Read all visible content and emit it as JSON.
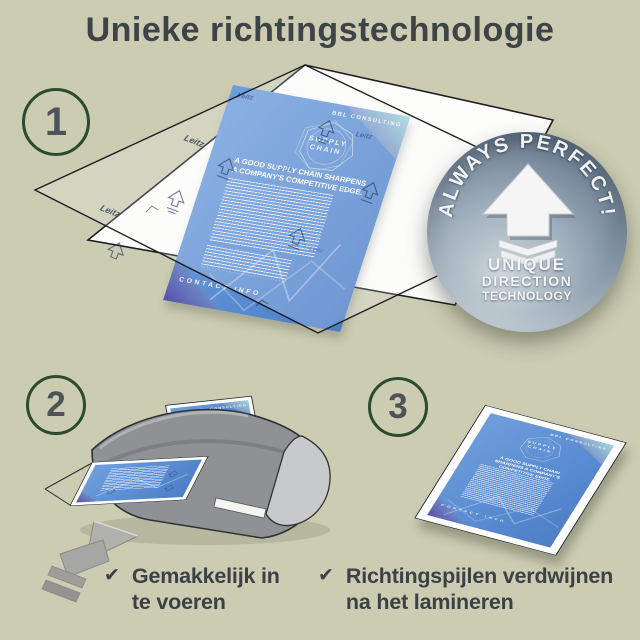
{
  "page": {
    "title": "Unieke richtingstechnologie",
    "background_color": "#cbccb2",
    "title_color": "#3e4347",
    "accent_green": "#2c4b2e"
  },
  "steps": {
    "one": "1",
    "two": "2",
    "three": "3"
  },
  "badge": {
    "arc_text": "ALWAYS PERFECT!",
    "line1": "UNIQUE",
    "line2": "DIRECTION",
    "line3": "TECHNOLOGY",
    "color": "#77899b"
  },
  "flyer": {
    "brand": "Leitz",
    "company": "BBL CONSULTING",
    "emblem_line1": "SUPPLY",
    "emblem_line2": "CHAIN",
    "headline": "A GOOD SUPPLY CHAIN SHARPENS A COMPANY'S COMPETITIVE EDGE.",
    "footer": "CONTACT INFO",
    "blue": "#5b8dd2"
  },
  "checklist": {
    "item1": {
      "glyph": "✔",
      "line1": "Gemakkelijk in",
      "line2": "te voeren"
    },
    "item2": {
      "glyph": "✔",
      "line1": "Richtingspijlen verdwijnen",
      "line2": "na het lamineren"
    }
  }
}
